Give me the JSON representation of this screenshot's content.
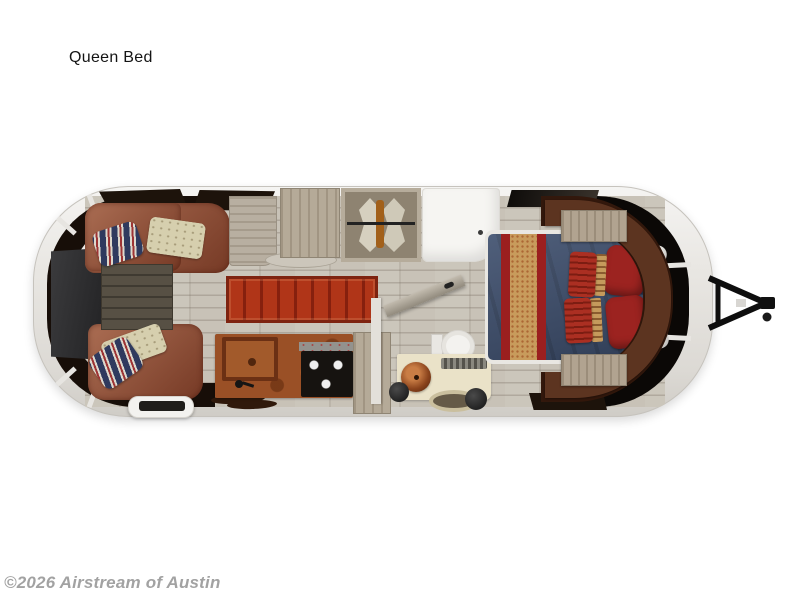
{
  "page": {
    "background": "#ffffff"
  },
  "header": {
    "title": "Queen Bed"
  },
  "watermark": {
    "text": "©2026 Airstream of Austin"
  },
  "floorplan": {
    "subject": "Airstream travel trailer top-down floor plan, hitch on right",
    "areas": [
      "front-lounge-l-shaped-leather-sofa",
      "wall-mounted-tv",
      "slatted-coffee-table",
      "striped-accent-pillows",
      "cream-accent-pillows",
      "red-runner-rug",
      "galley-counter-with-square-sink",
      "black-cooktop",
      "tall-pantry-cabinet",
      "wardrobe-cabinet",
      "hanging-closet-with-clothes",
      "shower-pan",
      "bathroom-open-door",
      "toilet",
      "vanity-with-copper-vessel-sink",
      "oval-basin",
      "queen-bed-with-blue-duvet",
      "tan-red-bed-runner",
      "bed-pillows",
      "curved-leather-headboard-surround",
      "nightstands",
      "wraparound-windows",
      "entry-step-with-mat",
      "a-frame-tow-hitch"
    ],
    "colors": {
      "shell": "#e9e7e3",
      "window_band": "#170e08",
      "sofa_leather": "#8f4c33",
      "rug_red": "#b03518",
      "counter_copper": "#9a5026",
      "bed_blue": "#3c4d6c",
      "runner_tan": "#c89b5c",
      "pillow_red": "#9c2320",
      "headboard_brown": "#5c3420",
      "floor_wood": "#c8c2b7",
      "cabinet_wood": "#b5aa98",
      "fixture_white": "#f6f5f2"
    }
  }
}
